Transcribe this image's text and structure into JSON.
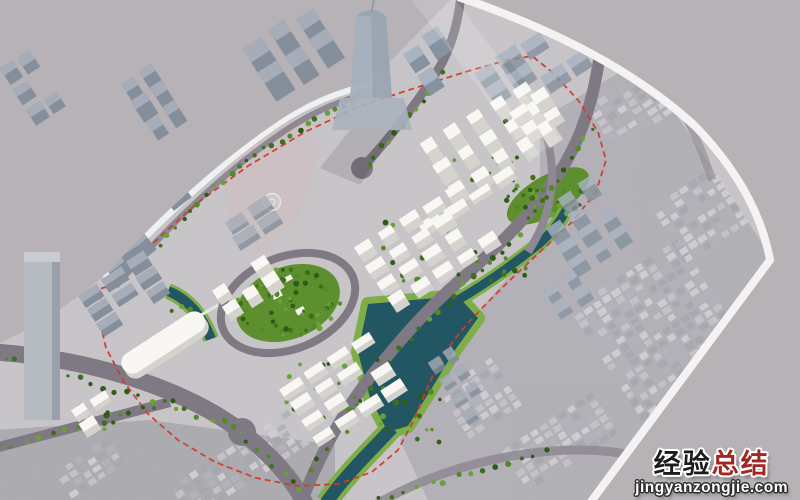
{
  "watermark": {
    "title_black": "经验",
    "title_red": "总结",
    "domain": "jingyanzongjie.com"
  },
  "colors": {
    "backdrop": "#b6b2b6",
    "ground": "#c9c6c9",
    "ground_tint_se": "#b3b1b7",
    "ground_tint_sw": "#a9a7ad",
    "demolition": "#cdc0c2",
    "quay": "#eef0f1",
    "board_edge": "#f4f2f3",
    "road": "#7e7983",
    "road_minor": "#8d8892",
    "green_pad": "#7fae49",
    "green_mid": "#5d8f2e",
    "water": "#235663",
    "red_dash": "#d23a2c",
    "white_top": "#f8f7f3",
    "white_side": "#d5d3cd",
    "gray_top": "#a6adb8",
    "gray_side": "#858f9b",
    "glass_top": "#a9b4c2",
    "glass_side": "#86929f",
    "wm_black": "#1c1c1c",
    "wm_red": "#a32621"
  },
  "scene": {
    "seed": 7,
    "default_rot": -33,
    "tree_colors": [
      "#3f6f1d",
      "#54892a",
      "#69a136",
      "#2f5c15"
    ],
    "fabric_colors": [
      "#c6c4ca",
      "#b4b2b9",
      "#d2d0d5",
      "#a9a7ae"
    ],
    "white_clusters": [
      {
        "id": "north-towers",
        "cx": 495,
        "cy": 148,
        "cols": 5,
        "rows": 3,
        "gx": 27,
        "gy": 24,
        "w": 15,
        "h": 11,
        "e": 12
      },
      {
        "id": "north-slab-row",
        "cx": 470,
        "cy": 204,
        "cols": 4,
        "rows": 1,
        "gx": 29,
        "gy": 18,
        "w": 22,
        "h": 8,
        "e": 6
      },
      {
        "id": "central-blocks",
        "cx": 430,
        "cy": 250,
        "cols": 5,
        "rows": 4,
        "gx": 27,
        "gy": 20,
        "w": 18,
        "h": 9,
        "e": 7
      },
      {
        "id": "ne-pair",
        "cx": 540,
        "cy": 120,
        "cols": 2,
        "rows": 2,
        "gx": 26,
        "gy": 20,
        "w": 16,
        "h": 10,
        "e": 9
      },
      {
        "id": "park-west-blocks",
        "cx": 250,
        "cy": 292,
        "cols": 3,
        "rows": 2,
        "gx": 24,
        "gy": 19,
        "w": 15,
        "h": 10,
        "e": 8
      },
      {
        "id": "south-residential",
        "cx": 345,
        "cy": 392,
        "cols": 4,
        "rows": 4,
        "gx": 28,
        "gy": 19,
        "w": 21,
        "h": 8,
        "e": 6
      },
      {
        "id": "sw-small-pair",
        "cx": 97,
        "cy": 416,
        "cols": 2,
        "rows": 2,
        "gx": 23,
        "gy": 17,
        "w": 16,
        "h": 9,
        "e": 6
      }
    ],
    "context_clusters": [
      {
        "id": "cbd-towers",
        "cx": 300,
        "cy": 62,
        "cols": 3,
        "rows": 2,
        "gx": 30,
        "gy": 28,
        "w": 20,
        "h": 14,
        "e": 20,
        "style": "gray",
        "outside": true
      },
      {
        "id": "cbd-east-towers",
        "cx": 438,
        "cy": 68,
        "cols": 2,
        "rows": 2,
        "gx": 26,
        "gy": 26,
        "w": 17,
        "h": 12,
        "e": 15,
        "style": "glass",
        "outside": true
      },
      {
        "id": "nw-corner-blocks",
        "cx": 36,
        "cy": 92,
        "cols": 2,
        "rows": 3,
        "gx": 20,
        "gy": 24,
        "w": 15,
        "h": 9,
        "e": 12,
        "style": "gray",
        "outside": true
      },
      {
        "id": "nw-tower-group",
        "cx": 158,
        "cy": 108,
        "cols": 2,
        "rows": 3,
        "gx": 22,
        "gy": 22,
        "w": 15,
        "h": 10,
        "e": 14,
        "style": "gray",
        "outside": true
      },
      {
        "id": "ne-glass-rows",
        "cx": 548,
        "cy": 66,
        "cols": 5,
        "rows": 3,
        "gx": 28,
        "gy": 20,
        "w": 22,
        "h": 10,
        "e": 9,
        "style": "glass",
        "op": 0.82
      },
      {
        "id": "quay-row",
        "cx": 150,
        "cy": 235,
        "cols": 4,
        "rows": 2,
        "gx": 30,
        "gy": 20,
        "w": 22,
        "h": 11,
        "e": 12,
        "style": "gray",
        "rot": -38
      },
      {
        "id": "west-slab-rows",
        "cx": 122,
        "cy": 290,
        "cols": 3,
        "rows": 4,
        "gx": 29,
        "gy": 17,
        "w": 23,
        "h": 8,
        "e": 7,
        "style": "gray"
      },
      {
        "id": "site-old-blocks",
        "cx": 255,
        "cy": 225,
        "cols": 2,
        "rows": 2,
        "gx": 28,
        "gy": 18,
        "w": 22,
        "h": 11,
        "e": 5,
        "style": "gray",
        "op": 0.8
      },
      {
        "id": "east-glass-towers",
        "cx": 588,
        "cy": 232,
        "cols": 3,
        "rows": 4,
        "gx": 25,
        "gy": 19,
        "w": 16,
        "h": 9,
        "e": 11,
        "style": "glass",
        "op": 0.8
      },
      {
        "id": "east-glass-lower",
        "cx": 570,
        "cy": 298,
        "cols": 2,
        "rows": 2,
        "gx": 24,
        "gy": 18,
        "w": 14,
        "h": 9,
        "e": 8,
        "style": "glass",
        "op": 0.75
      },
      {
        "id": "pond-east-lowrise",
        "cx": 462,
        "cy": 388,
        "cols": 2,
        "rows": 4,
        "gx": 17,
        "gy": 20,
        "w": 12,
        "h": 9,
        "e": 5,
        "style": "gray",
        "op": 0.8
      }
    ],
    "fabric_blocks": [
      {
        "id": "fabric-east",
        "cx": 660,
        "cy": 330,
        "cols": 12,
        "rows": 16,
        "gx": 11,
        "gy": 8.5,
        "w": 8,
        "h": 6
      },
      {
        "id": "fabric-ne",
        "cx": 700,
        "cy": 215,
        "cols": 7,
        "rows": 8,
        "gx": 11,
        "gy": 8.5,
        "w": 8,
        "h": 6
      },
      {
        "id": "fabric-top-right",
        "cx": 645,
        "cy": 100,
        "cols": 9,
        "rows": 6,
        "gx": 12,
        "gy": 9,
        "w": 9,
        "h": 6
      },
      {
        "id": "fabric-south",
        "cx": 560,
        "cy": 442,
        "cols": 10,
        "rows": 6,
        "gx": 11,
        "gy": 8.5,
        "w": 8,
        "h": 6
      },
      {
        "id": "fabric-pond-se",
        "cx": 480,
        "cy": 398,
        "cols": 6,
        "rows": 7,
        "gx": 11,
        "gy": 8.5,
        "w": 8,
        "h": 6
      },
      {
        "id": "fabric-sw",
        "cx": 240,
        "cy": 465,
        "cols": 13,
        "rows": 5,
        "gx": 11,
        "gy": 8.5,
        "w": 8,
        "h": 6
      },
      {
        "id": "fabric-sw-corner",
        "cx": 90,
        "cy": 468,
        "cols": 6,
        "rows": 4,
        "gx": 11,
        "gy": 8.5,
        "w": 8,
        "h": 6
      }
    ],
    "tree_rows": [
      {
        "x1": 118,
        "y1": 282,
        "x2": 240,
        "y2": 165,
        "n": 16
      },
      {
        "x1": 240,
        "y1": 165,
        "x2": 368,
        "y2": 90,
        "n": 16
      },
      {
        "x1": 5,
        "y1": 358,
        "x2": 235,
        "y2": 425,
        "n": 20
      },
      {
        "x1": 240,
        "y1": 435,
        "x2": 300,
        "y2": 492,
        "n": 8
      },
      {
        "x1": 310,
        "y1": 470,
        "x2": 390,
        "y2": 360,
        "n": 12
      },
      {
        "x1": 400,
        "y1": 345,
        "x2": 520,
        "y2": 235,
        "n": 14
      },
      {
        "x1": 530,
        "y1": 220,
        "x2": 590,
        "y2": 130,
        "n": 10
      },
      {
        "x1": 368,
        "y1": 165,
        "x2": 445,
        "y2": 75,
        "n": 12
      },
      {
        "x1": 0,
        "y1": 448,
        "x2": 170,
        "y2": 403,
        "n": 14
      },
      {
        "x1": 380,
        "y1": 498,
        "x2": 545,
        "y2": 452,
        "n": 14
      }
    ],
    "tree_patches": [
      {
        "id": "central-park-trees",
        "cx": 288,
        "cy": 303,
        "rx": 52,
        "ry": 34,
        "n": 60
      },
      {
        "id": "ne-hill-trees",
        "cx": 548,
        "cy": 196,
        "rx": 44,
        "ry": 20,
        "n": 28
      },
      {
        "id": "north-pad-trees",
        "cx": 495,
        "cy": 150,
        "rx": 55,
        "ry": 38,
        "n": 16
      },
      {
        "id": "central-pad-trees",
        "cx": 432,
        "cy": 248,
        "rx": 60,
        "ry": 42,
        "n": 18
      },
      {
        "id": "south-pad-trees",
        "cx": 345,
        "cy": 392,
        "rx": 62,
        "ry": 44,
        "n": 20
      },
      {
        "id": "west-pad-trees",
        "cx": 250,
        "cy": 292,
        "rx": 34,
        "ry": 22,
        "n": 10
      },
      {
        "id": "sw-pad-trees",
        "cx": 97,
        "cy": 416,
        "rx": 24,
        "ry": 15,
        "n": 8
      },
      {
        "id": "pond-bank-trees",
        "cx": 420,
        "cy": 420,
        "rx": 40,
        "ry": 30,
        "n": 12
      },
      {
        "id": "left-channel-trees",
        "cx": 180,
        "cy": 320,
        "rx": 20,
        "ry": 14,
        "n": 8
      },
      {
        "id": "ne-channel-trees",
        "cx": 500,
        "cy": 270,
        "rx": 28,
        "ry": 18,
        "n": 10
      }
    ]
  }
}
